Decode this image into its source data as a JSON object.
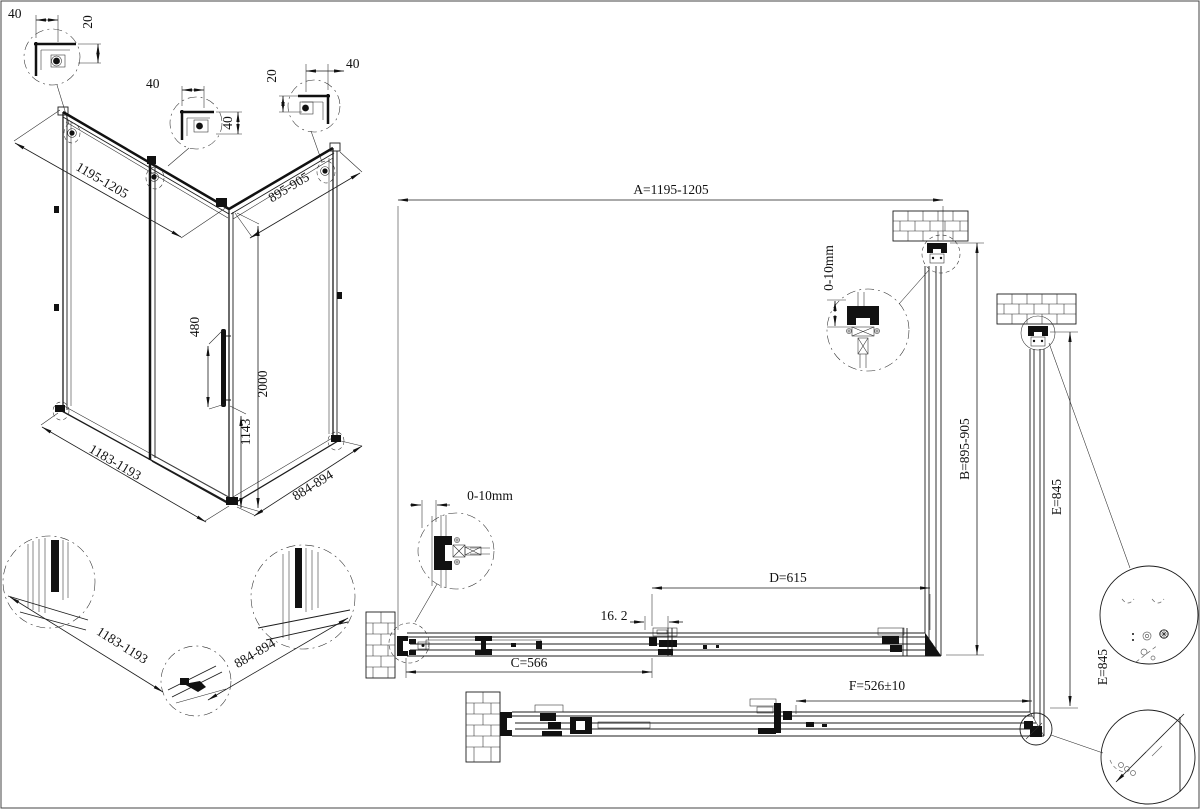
{
  "corner_details": {
    "c1": {
      "top": "40",
      "side": "20"
    },
    "c2": {
      "top": "40",
      "side": "40"
    },
    "c3": {
      "side": "20",
      "top": "40"
    }
  },
  "iso": {
    "top_width": "1195-1205",
    "top_depth": "895-905",
    "handle_len": "480",
    "height": "2000",
    "handle_pos": "1143",
    "bottom_width": "1183-1193",
    "bottom_depth": "884-894"
  },
  "base_details": {
    "width": "1183-1193",
    "depth": "884-894"
  },
  "plan": {
    "dim_a": "A=1195-1205",
    "dim_b": "B=895-905",
    "dim_c": "C=566",
    "dim_d": "D=615",
    "dim_e": "E=845",
    "dim_e2": "E=845",
    "dim_f": "F=526±10",
    "dim_gap": "16. 2",
    "adj_top": "0-10mm",
    "adj_left": "0-10mm"
  }
}
